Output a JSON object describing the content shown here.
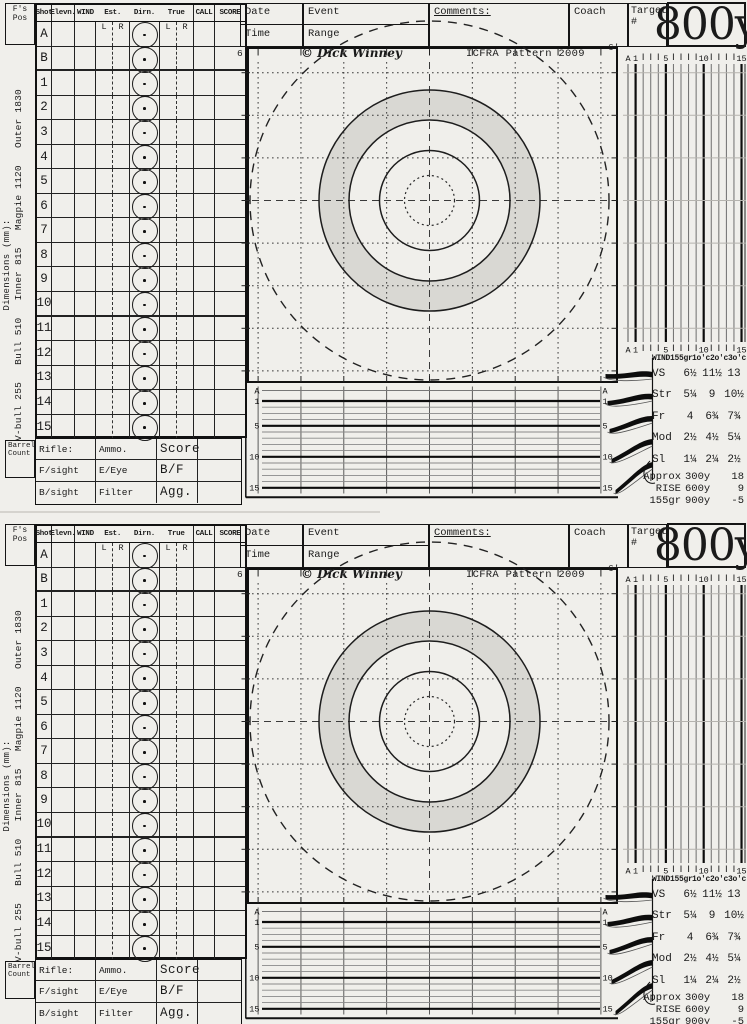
{
  "colors": {
    "paper": "#f0efeb",
    "ink": "#1a1a1a",
    "ring_shade": "#d9d8d3",
    "faint_line": "#b5b3ae"
  },
  "card": {
    "dims": {
      "label": "Dimensions (mm):",
      "values": [
        "V-bull 255",
        "Bull 510",
        "Inner 815",
        "Magpie 1120",
        "Outer 1830"
      ]
    },
    "score_table": {
      "fs_pos": "F's Pos",
      "headers": {
        "shot": "Shot",
        "elevn": "Elevn.",
        "wind": "WIND",
        "est": "Est.",
        "dirn": "Dirn.",
        "truec": "True",
        "call": "CALL",
        "score": "SCORE",
        "l": "L",
        "r": "R"
      },
      "rows": [
        "A",
        "B",
        "1",
        "2",
        "3",
        "4",
        "5",
        "6",
        "7",
        "8",
        "9",
        "10",
        "11",
        "12",
        "13",
        "14",
        "15"
      ]
    },
    "equipment": {
      "barrel_line1": "Barrel",
      "barrel_line2": "Count",
      "rows": [
        [
          "Rifle:",
          "Ammo.",
          "Score"
        ],
        [
          "F/sight",
          "E/Eye",
          "B/F"
        ],
        [
          "B/sight",
          "Filter",
          "Agg."
        ]
      ]
    },
    "header": {
      "date": "Date",
      "time": "Time",
      "event": "Event",
      "range": "Range",
      "comments": "Comments:",
      "coach": "Coach",
      "target_label": "Target #",
      "target_value": "800y"
    },
    "plot": {
      "copyright": "© Dick Winney",
      "pattern": "ICFRA Pattern 2009",
      "six_left": "6'",
      "six_right": "6'"
    },
    "scales": {
      "labels": [
        "A",
        "1",
        "5",
        "10",
        "15"
      ]
    },
    "wind": {
      "title": "WIND",
      "grain": "155gr",
      "cols": [
        "1o'c",
        "2o'c",
        "3o'c"
      ],
      "rows": [
        {
          "label": "VS",
          "values": [
            "6½",
            "11½",
            "13"
          ]
        },
        {
          "label": "Str",
          "values": [
            "5¼",
            "9",
            "10½"
          ]
        },
        {
          "label": "Fr",
          "values": [
            "4",
            "6¾",
            "7¾"
          ]
        },
        {
          "label": "Mod",
          "values": [
            "2½",
            "4½",
            "5¼"
          ]
        },
        {
          "label": "Sl",
          "values": [
            "1¼",
            "2¼",
            "2½"
          ]
        }
      ],
      "footer": [
        {
          "label": "Approx",
          "range": "300y",
          "value": "18"
        },
        {
          "label": "RISE",
          "range": "600y",
          "value": "9"
        },
        {
          "label": "155gr",
          "range": "900y",
          "value": "-5"
        }
      ]
    }
  }
}
